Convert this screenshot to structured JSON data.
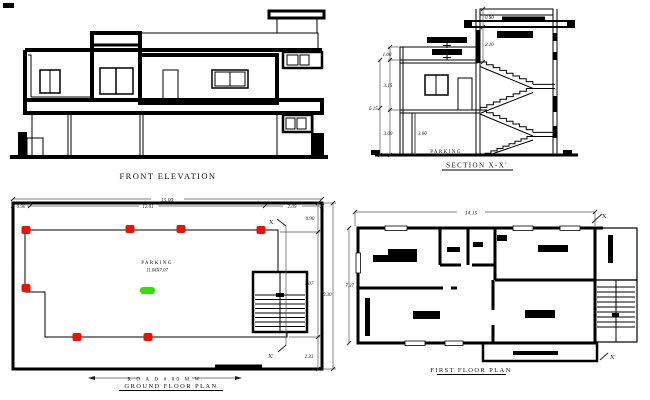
{
  "front_elevation": {
    "title": "FRONT ELEVATION"
  },
  "section": {
    "title": "SECTION X-X'",
    "parking_label": "PARKING",
    "dims": {
      "parapet": "0.90",
      "headroom": "2.10",
      "top_left": "1.00",
      "first_floor": "3.15",
      "total": "6.15",
      "ground": "3.00",
      "ground_inner": "3.00"
    }
  },
  "ground_floor_plan": {
    "title": "GROUND FLOOR PLAN",
    "road_label": "R O A D 6.00 M.W.",
    "parking_label": "PARKING",
    "parking_size": "11.04X7.07",
    "marker_top": "X",
    "marker_bottom": "X'",
    "dims": {
      "overall_width": "15.00",
      "left": "0.90",
      "middle": "12.01",
      "right": "2.09",
      "top": "0.90",
      "inner_height": "7.07",
      "overall_height": "10.30",
      "bottom": "2.33"
    }
  },
  "first_floor_plan": {
    "title": "FIRST FLOOR PLAN",
    "marker_top": "X",
    "marker_bottom": "X'",
    "dims": {
      "overall_width": "14.15",
      "overall_height": "7.37"
    }
  },
  "colors": {
    "line": "#000000",
    "dimension": "#555555",
    "column_red": "#ee1000",
    "parking_green": "#2ce400"
  }
}
